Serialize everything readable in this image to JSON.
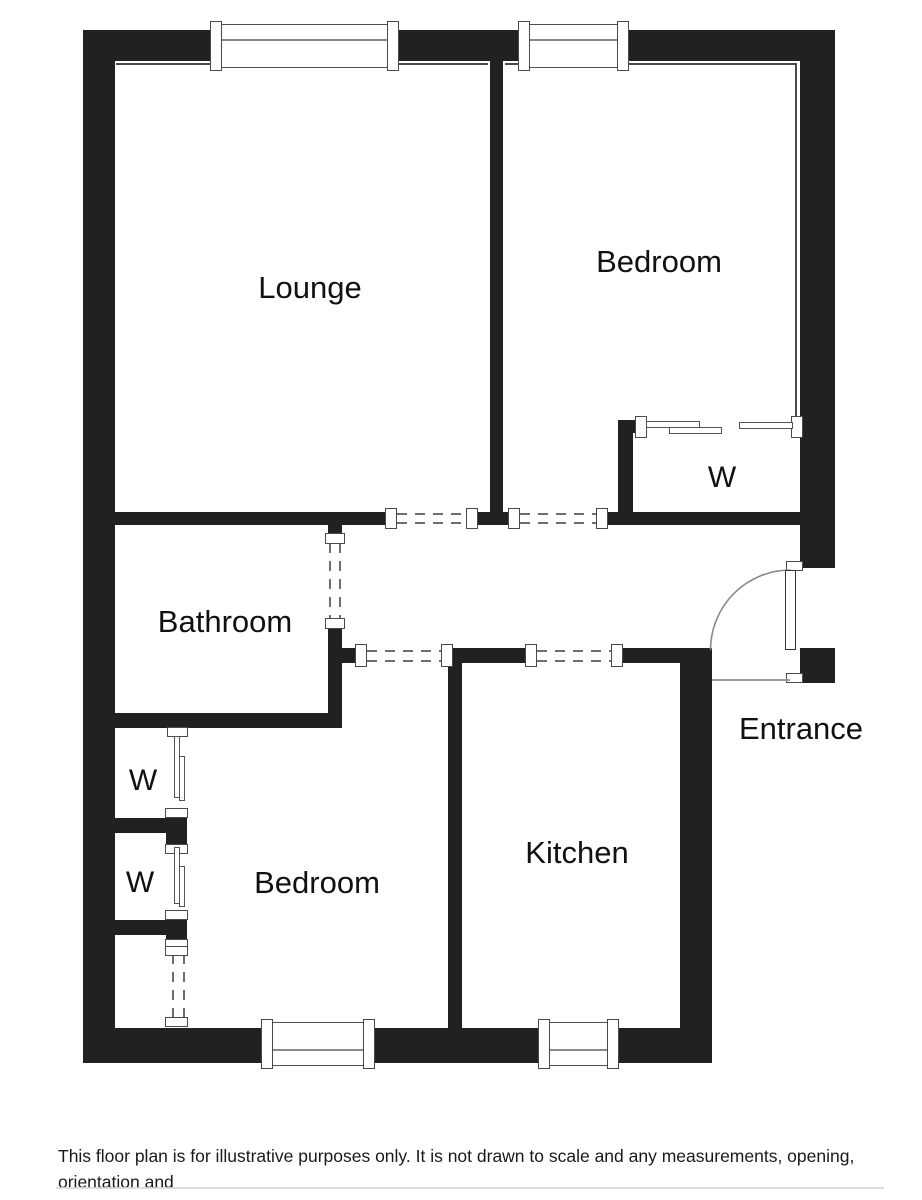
{
  "plan": {
    "wall_color": "#212121",
    "labels": [
      {
        "id": "lounge",
        "text": "Lounge"
      },
      {
        "id": "bedroom-top",
        "text": "Bedroom"
      },
      {
        "id": "wardrobe-top",
        "text": "W"
      },
      {
        "id": "bathroom",
        "text": "Bathroom"
      },
      {
        "id": "entrance",
        "text": "Entrance"
      },
      {
        "id": "kitchen",
        "text": "Kitchen"
      },
      {
        "id": "bedroom-bottom",
        "text": "Bedroom"
      },
      {
        "id": "wardrobe-left-1",
        "text": "W"
      },
      {
        "id": "wardrobe-left-2",
        "text": "W"
      }
    ],
    "features": {
      "entrance_door": "door-swing-arc",
      "wardrobe_fronts": "sliding-door-panels",
      "openings": "dashed-lines",
      "windows": 4
    }
  },
  "disclaimer": {
    "line1": "This floor plan is for illustrative purposes only. It is not drawn to scale and any measurements, opening, orientation and",
    "line2": "floor areas are all approximate. No details are guaranteed. No liability is taken for any error, omission or misstatement."
  }
}
